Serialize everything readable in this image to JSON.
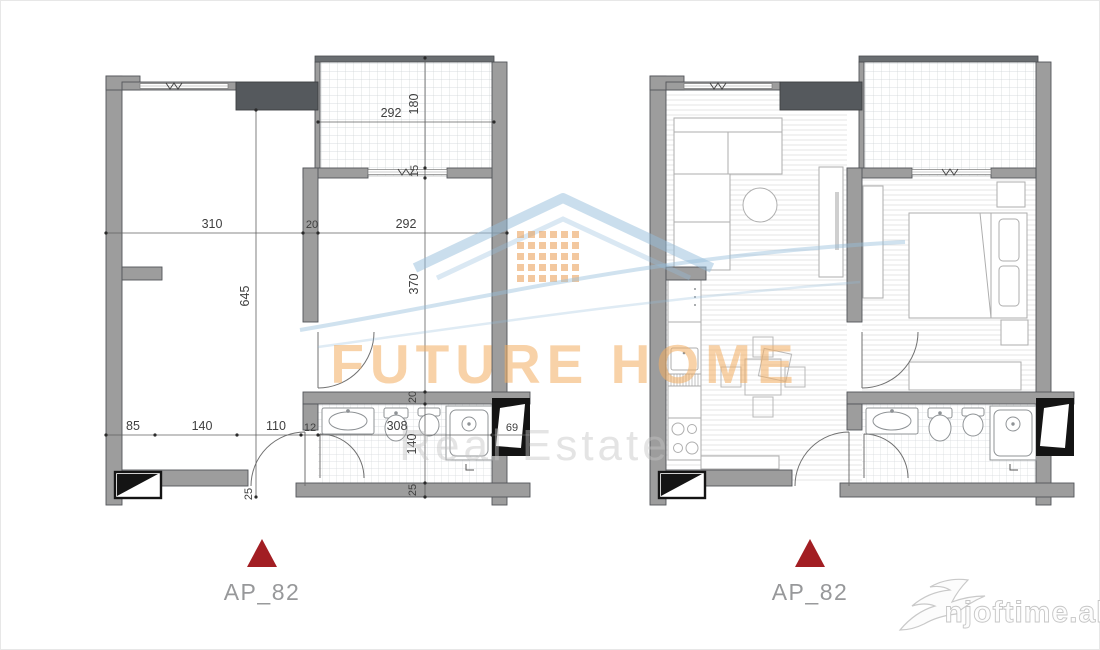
{
  "image_type": "apartment-floor-plan",
  "watermark": {
    "brand": "FUTURE HOME",
    "tagline": "Real Estate",
    "site": "njoftime.al"
  },
  "icons": {
    "brand_logo": "house-roof-with-windows",
    "site_logo": "swallow-bird",
    "marker": "triangle-up"
  },
  "plans": {
    "left": {
      "style": "dimensioned technical plan",
      "label": "AP_82"
    },
    "right": {
      "style": "furnished plan",
      "label": "AP_82"
    }
  },
  "dims": {
    "balcony_w": "292",
    "balcony_h": "180",
    "sill": "15",
    "living_w": "310",
    "wall_mid": "20",
    "bedroom_w": "292",
    "living_h": "645",
    "bedroom_h": "370",
    "seg_85": "85",
    "seg_140": "140",
    "seg_110": "110",
    "seg_12": "12",
    "bath_w": "308",
    "shaft_w": "69",
    "wall_top": "20",
    "bath_h": "140",
    "bottom_wall": "25",
    "door_offset": "25"
  },
  "colors": {
    "wall": "#9d9d9d",
    "wall_edge": "#53565a",
    "shaft_dark": "#55595d",
    "marker_red": "#a21e23",
    "brand_orange": "#f3ad60",
    "brand_blue": "#8ab4d8",
    "tile_line": "#ced3d6",
    "label_gray": "#97989a"
  }
}
